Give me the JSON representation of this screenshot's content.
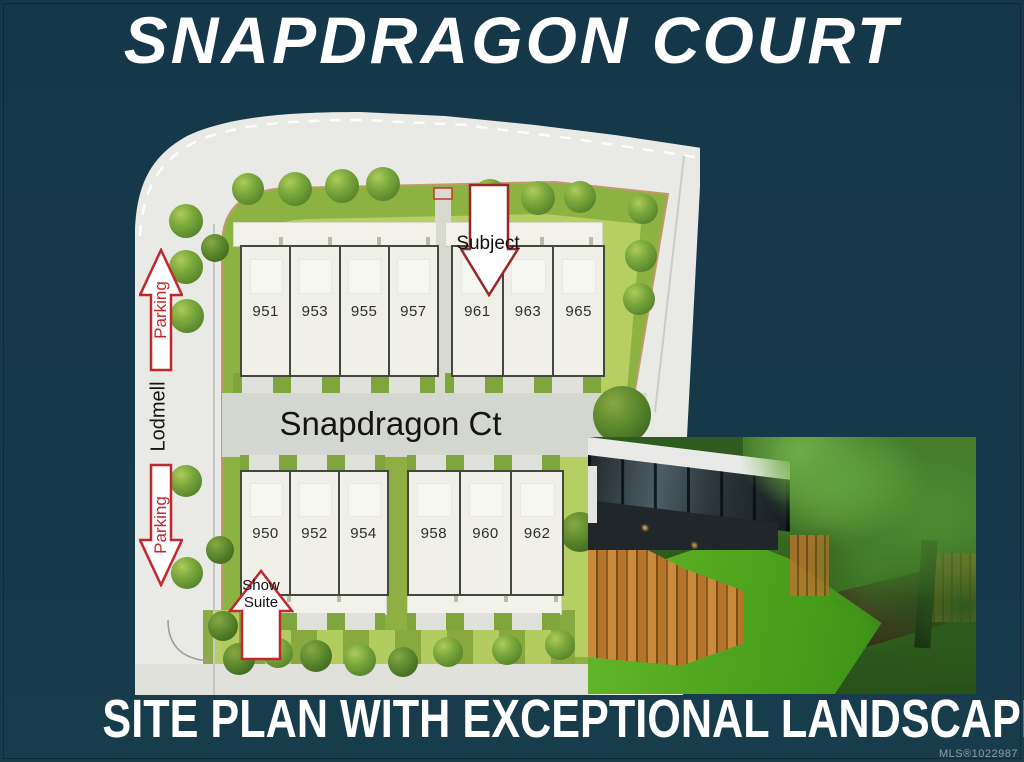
{
  "title": "SNAPDRAGON COURT",
  "caption": "SITE PLAN WITH EXCEPTIONAL LANDSCAPE",
  "mls": "MLS®1022987",
  "colors": {
    "background_teal": "#16394a",
    "parking_arrow_red": "#c2272d",
    "subject_arrow_red": "#99272a",
    "plan_green": "#8cb341",
    "road_white": "#e9eae5",
    "road_gray": "#d4d7d0"
  },
  "site_plan": {
    "street_horizontal": "Snapdragon Ct",
    "street_vertical": "Lodmell",
    "annotations": {
      "subject": "Subject",
      "show_suite_line1": "Show",
      "show_suite_line2": "Suite",
      "parking_upper": "Parking",
      "parking_lower": "Parking"
    },
    "buildings": {
      "top_left": {
        "units": [
          "951",
          "953",
          "955",
          "957"
        ]
      },
      "top_right": {
        "units": [
          "961",
          "963",
          "965"
        ]
      },
      "bottom_left": {
        "units": [
          "950",
          "952",
          "954"
        ]
      },
      "bottom_right": {
        "units": [
          "958",
          "960",
          "962"
        ]
      }
    }
  }
}
